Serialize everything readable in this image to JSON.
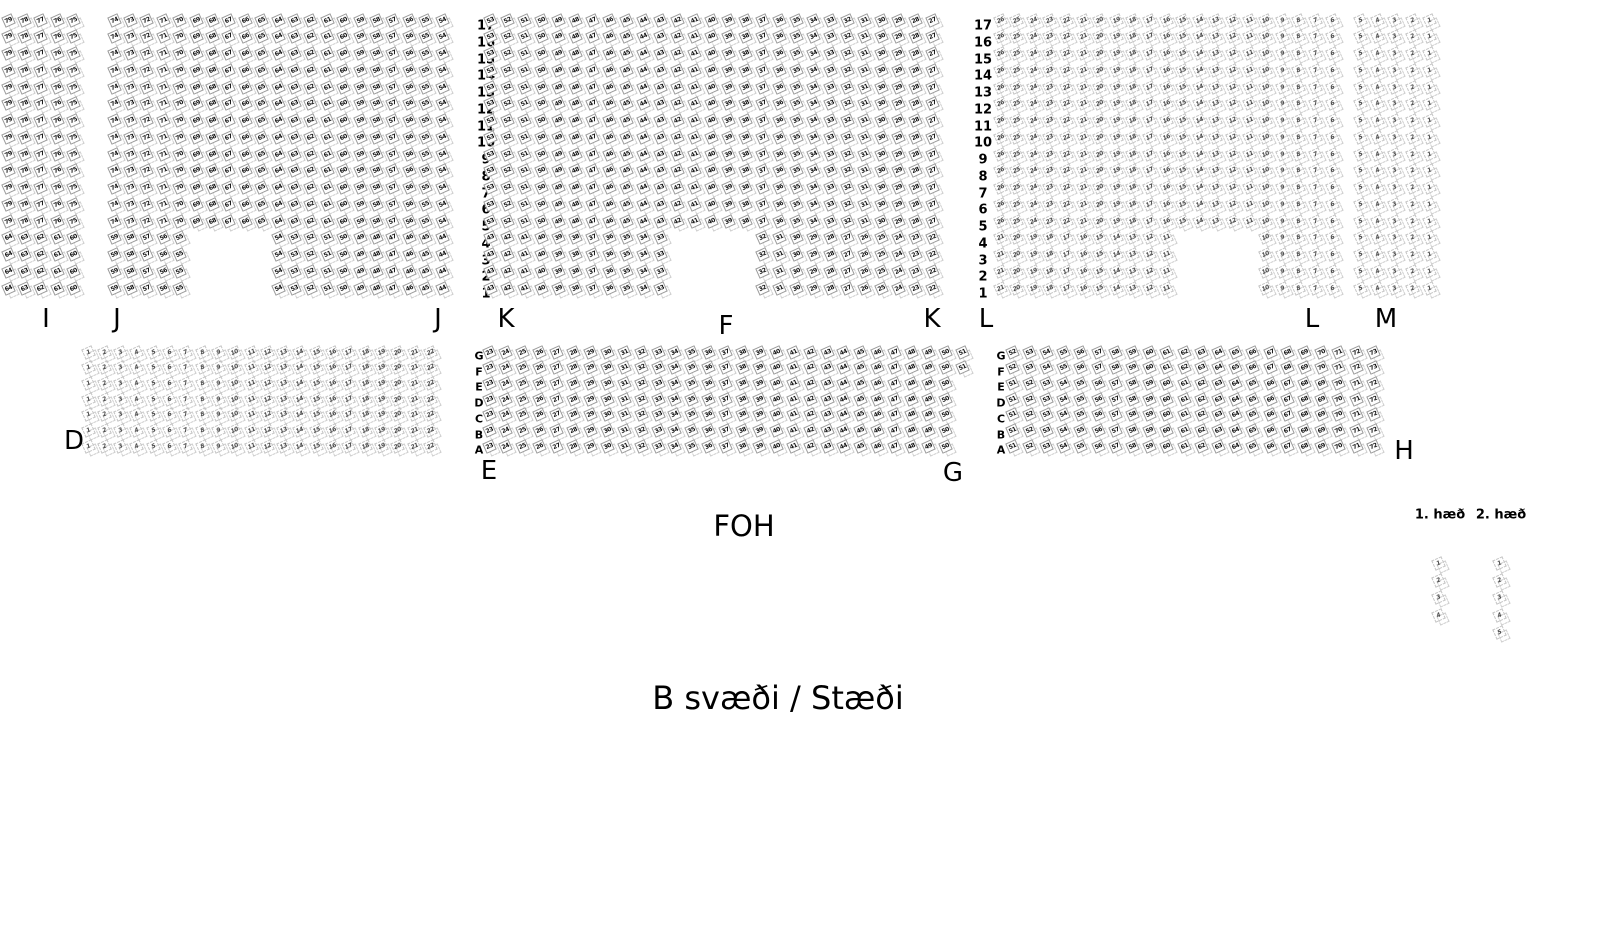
{
  "canvas": {
    "width": 1610,
    "height": 950,
    "background": "#ffffff"
  },
  "colors": {
    "seat_filled_text": "#111111",
    "seat_filled_border": "#9a9a9a",
    "seat_outline_text": "#4a4a4a",
    "seat_outline_border": "#c4c4c4",
    "ghost_border": "#cfcfcf",
    "label_text": "#000000"
  },
  "foh_label": "FOH",
  "area_label": "B svæði / Stæði",
  "top_band": {
    "y_first_row_center": 22,
    "row_pitch": 16.75,
    "rows": [
      17,
      16,
      15,
      14,
      13,
      12,
      11,
      10,
      9,
      8,
      7,
      6,
      5,
      4,
      3,
      2,
      1
    ],
    "short_rows_max": 4,
    "row_number_columns": [
      {
        "x": 486
      },
      {
        "x": 983
      }
    ],
    "sections": [
      {
        "name": "I",
        "x0": 10,
        "pitch": 16.4,
        "cols": 5,
        "state": "filled",
        "full_run": {
          "from": 79,
          "to": 75
        },
        "short_runs": [
          {
            "col0": 0,
            "from": 64,
            "to": 60
          }
        ]
      },
      {
        "name": "J",
        "x0": 116,
        "pitch": 16.4,
        "cols": 21,
        "state": "filled",
        "full_run": {
          "from": 74,
          "to": 54
        },
        "short_runs": [
          {
            "col0": 0,
            "from": 59,
            "to": 55
          },
          {
            "col0": 10,
            "from": 54,
            "to": 44
          }
        ]
      },
      {
        "name": "K",
        "x0": 492,
        "pitch": 17.0,
        "cols": 27,
        "state": "filled",
        "full_run": {
          "from": 53,
          "to": 27
        },
        "short_runs": [
          {
            "col0": 0,
            "from": 43,
            "to": 33
          },
          {
            "col0": 16,
            "from": 32,
            "to": 22
          }
        ]
      },
      {
        "name": "L",
        "x0": 1002,
        "pitch": 16.6,
        "cols": 21,
        "state": "outline",
        "full_run": {
          "from": 26,
          "to": 6
        },
        "short_runs": [
          {
            "col0": 0,
            "from": 21,
            "to": 11
          },
          {
            "col0": 16,
            "from": 10,
            "to": 6
          }
        ]
      },
      {
        "name": "M",
        "x0": 1362,
        "pitch": 17.4,
        "cols": 5,
        "state": "outline",
        "full_run": {
          "from": 5,
          "to": 1
        },
        "short_runs": [
          {
            "col0": 0,
            "from": 5,
            "to": 1
          }
        ]
      }
    ]
  },
  "middle_band": {
    "y_first_row_center": 354,
    "row_pitch": 15.7,
    "row_letters": [
      "G",
      "F",
      "E",
      "D",
      "C",
      "B",
      "A"
    ],
    "letter_columns": [
      {
        "x": 479
      },
      {
        "x": 1001
      }
    ],
    "sections": [
      {
        "name": "D",
        "x0": 90,
        "pitch": 16.3,
        "state": "outline",
        "rows": [
          {
            "letter": "G",
            "from": 1,
            "to": 22
          },
          {
            "letter": "F",
            "from": 1,
            "to": 22
          },
          {
            "letter": "E",
            "from": 1,
            "to": 22
          },
          {
            "letter": "D",
            "from": 1,
            "to": 22
          },
          {
            "letter": "C",
            "from": 1,
            "to": 22
          },
          {
            "letter": "B",
            "from": 1,
            "to": 22
          },
          {
            "letter": "A",
            "from": 1,
            "to": 22
          }
        ]
      },
      {
        "name": "E",
        "x0": 491,
        "pitch": 16.9,
        "state": "filled",
        "rows": [
          {
            "letter": "G",
            "from": 23,
            "to": 51
          },
          {
            "letter": "F",
            "from": 23,
            "to": 51
          },
          {
            "letter": "E",
            "from": 23,
            "to": 50
          },
          {
            "letter": "D",
            "from": 23,
            "to": 50
          },
          {
            "letter": "C",
            "from": 23,
            "to": 50
          },
          {
            "letter": "B",
            "from": 23,
            "to": 50
          },
          {
            "letter": "A",
            "from": 23,
            "to": 50
          }
        ]
      },
      {
        "name": "H",
        "x0": 1014,
        "pitch": 17.2,
        "state": "filled",
        "rows": [
          {
            "letter": "G",
            "from": 52,
            "to": 73
          },
          {
            "letter": "F",
            "from": 52,
            "to": 73
          },
          {
            "letter": "E",
            "from": 51,
            "to": 72
          },
          {
            "letter": "D",
            "from": 51,
            "to": 72
          },
          {
            "letter": "C",
            "from": 51,
            "to": 72
          },
          {
            "letter": "B",
            "from": 51,
            "to": 72
          },
          {
            "letter": "A",
            "from": 51,
            "to": 72
          }
        ]
      }
    ]
  },
  "section_labels": [
    {
      "text": "I",
      "x": 46,
      "y": 319
    },
    {
      "text": "J",
      "x": 117,
      "y": 319
    },
    {
      "text": "J",
      "x": 438,
      "y": 319
    },
    {
      "text": "K",
      "x": 506,
      "y": 319
    },
    {
      "text": "F",
      "x": 726,
      "y": 326
    },
    {
      "text": "K",
      "x": 932,
      "y": 319
    },
    {
      "text": "L",
      "x": 986,
      "y": 319
    },
    {
      "text": "L",
      "x": 1312,
      "y": 319
    },
    {
      "text": "M",
      "x": 1386,
      "y": 319
    },
    {
      "text": "D",
      "x": 74,
      "y": 441
    },
    {
      "text": "E",
      "x": 489,
      "y": 471
    },
    {
      "text": "G",
      "x": 953,
      "y": 473
    },
    {
      "text": "H",
      "x": 1404,
      "y": 451
    }
  ],
  "balcony": {
    "label_y": 515,
    "y_first_seat_center": 565,
    "pitch": 17.4,
    "state": "outline",
    "columns": [
      {
        "label": "1. hæð",
        "x": 1440,
        "seats": [
          1,
          2,
          3,
          4
        ]
      },
      {
        "label": "2. hæð",
        "x": 1501,
        "seats": [
          1,
          2,
          3,
          4,
          5
        ]
      }
    ]
  }
}
